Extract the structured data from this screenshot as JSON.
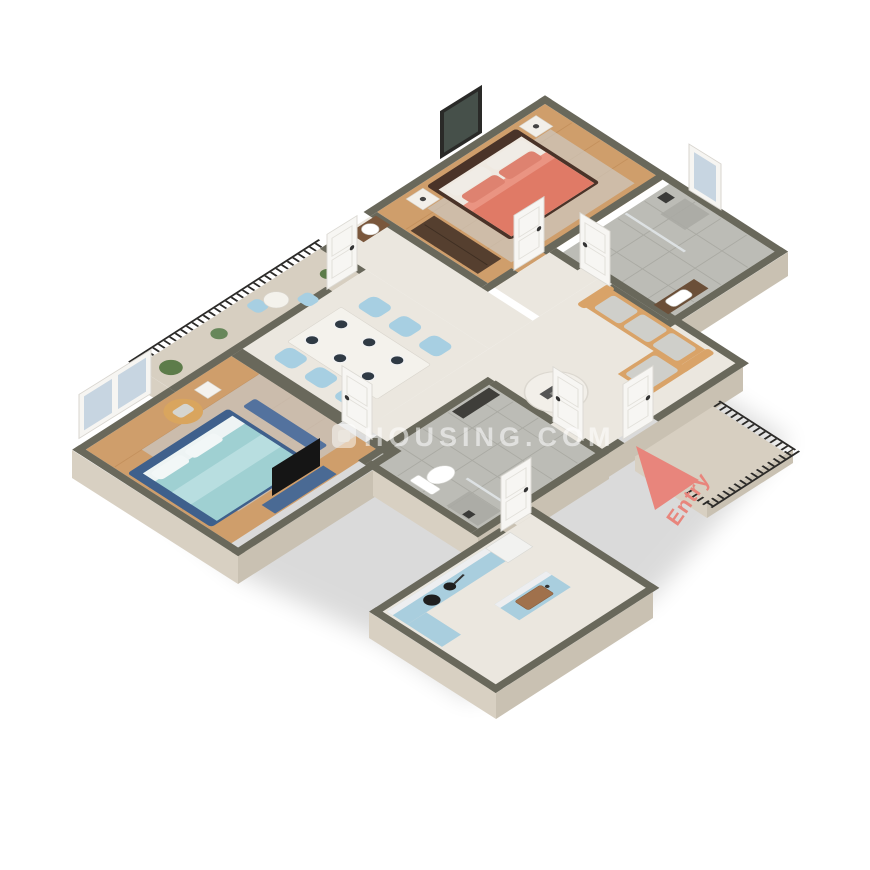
{
  "scene": {
    "type": "isometric-3d-floor-plan",
    "rooms": [
      "master-bedroom",
      "ensuite-bathroom",
      "long-balcony",
      "dining-area",
      "second-bedroom",
      "living-hall",
      "common-bathroom",
      "kitchen",
      "entry-balcony"
    ]
  },
  "watermark": {
    "text": "HOUSING.COM"
  },
  "entry": {
    "label": "Entry"
  },
  "colors": {
    "background": "#ffffff",
    "wall_top": "#69685b",
    "wall_face_light": "#d8d0c2",
    "wall_face_dark": "#c9c1b2",
    "floor_marble": "#ebe7df",
    "floor_wood": "#cf9e6b",
    "floor_tile": "#bcbcb6",
    "floor_stone": "#d7cfc1",
    "sofa": "#d9a368",
    "bed_master": "#e07a66",
    "bed_second": "#9fd0d2",
    "chair_blue": "#a7cfe2",
    "cabinet_blue": "#a9cede",
    "railing": "#2b2a28",
    "door_white": "#f7f6f3",
    "wardrobe_brown": "#553f2f",
    "console_blue": "#4a6a94",
    "accent_entry": "#e8857c",
    "watermark": "#ffffff"
  }
}
